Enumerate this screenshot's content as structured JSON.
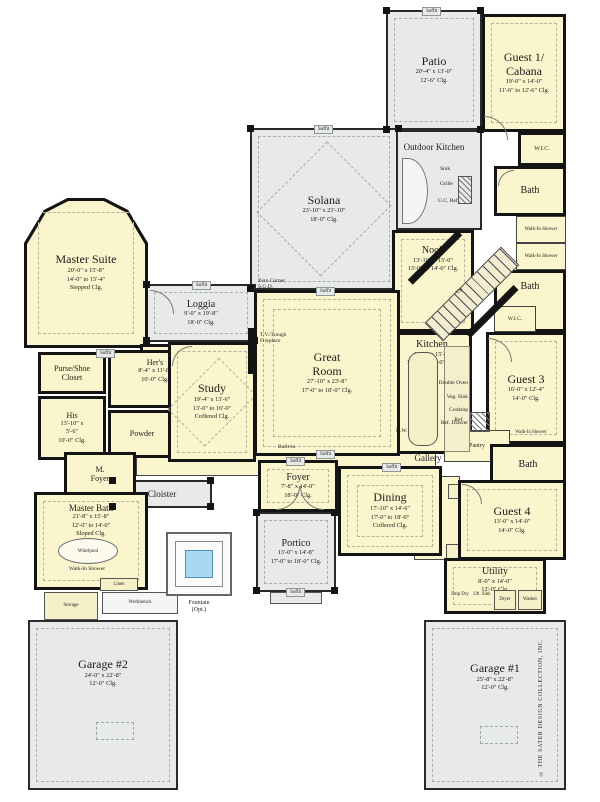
{
  "colors": {
    "room_fill": "#FAF5CC",
    "outdoor_fill": "#E8E9E9",
    "wall": "#141414",
    "fountain_water": "#A9D9F0"
  },
  "credit": "© THE SATER DESIGN COLLECTION, INC.",
  "labels": {
    "soffit": "Soffit",
    "up": "Up",
    "zero_corner": "Zero Corner",
    "sgd": "S.G.D.",
    "fireplace1": "T.V./Trough",
    "fireplace2": "Fireplace",
    "built_in": "Built-in",
    "gallery": "Gallery",
    "ref": "Ref.",
    "pantry": "Pantry",
    "linen": "Linen",
    "vest": "Vest",
    "closet": "Closet",
    "powder": "Powder",
    "storage": "Storage",
    "workbench": "Workbench",
    "whirlpool": "Whirlpool",
    "walk_in_shower": "Walk-In Shower",
    "wic": "W.I.C.",
    "bath": "Bath",
    "sink": "Sink",
    "grille": "Grille",
    "uc_ref": "U.C. Ref.",
    "dw": "D.W.",
    "double_oven": "Double Oven",
    "veg_sink": "Veg. Sink",
    "cooktop": "Cooktop",
    "ref_drawer": "Ref. Drawer",
    "drip_dry": "Drip Dry",
    "utl_sink": "Utl. Sink",
    "dryer": "Dryer",
    "washer": "Washer",
    "fountain": "Fountain",
    "fountain_opt": "(Opt.)"
  },
  "rooms": {
    "patio": {
      "name": "Patio",
      "l1": "20'-4\" x 13'-0\"",
      "l2": "12'-6\" Clg."
    },
    "guest1": {
      "name": "Guest 1/",
      "name2": "Cabana",
      "l1": "19'-0\" x 14'-0\"",
      "l2": "11'-6\" to 12'-6\" Clg."
    },
    "outdoor_kitchen": {
      "name": "Outdoor Kitchen"
    },
    "solana": {
      "name": "Solana",
      "l1": "23'-10\" x 23'-10\"",
      "l2": "18'-0\" Clg."
    },
    "nook": {
      "name": "Nook",
      "l1": "13'-10\" x 15'-0\"",
      "l2": "13'-0\" to 14'-0\" Clg."
    },
    "kitchen": {
      "name": "Kitchen",
      "l1": "19'-2\" x 15'-0\"",
      "l2": "13'-0\" to 14'-0\" Clg."
    },
    "guest3": {
      "name": "Guest 3",
      "l1": "16'-0\" x 12'-4\"",
      "l2": "14'-0\" Clg."
    },
    "master_suite": {
      "name": "Master Suite",
      "l1": "20'-0\" x 15'-8\"",
      "l2": "14'-0\" to 15'-4\"",
      "l3": "Stepped Clg."
    },
    "loggia": {
      "name": "Loggia",
      "l1": "9'-0\" x 19'-8\"",
      "l2": "18'-0\" Clg."
    },
    "pool_bath": {
      "name": "Pool",
      "name2": "Bath"
    },
    "study": {
      "name": "Study",
      "l1": "19'-4\" x 13'-6\"",
      "l2": "13'-0\" to 16'-0\"",
      "l3": "Coffered Clg."
    },
    "great_room": {
      "name": "Great",
      "name2": "Room",
      "l1": "27'-10\" x 23'-8\"",
      "l2": "17'-0\" to 18'-0\" Clg."
    },
    "purse_shoe": {
      "name": "Purse/Shoe",
      "name2": "Closet"
    },
    "hers": {
      "name": "Her's",
      "l1": "8'-4\" x 11'-8\"",
      "l2": "10'-0\" Clg."
    },
    "his": {
      "name": "His",
      "l1": "13'-10\" x",
      "l2": "5'-6\"",
      "l3": "10'-0\" Clg."
    },
    "m_foyer": {
      "name": "M.",
      "name2": "Foyer"
    },
    "cloister": {
      "name": "Cloister"
    },
    "foyer": {
      "name": "Foyer",
      "l1": "7'-8\" x 14'-0\"",
      "l2": "18'-0\" Clg."
    },
    "dining": {
      "name": "Dining",
      "l1": "17'-10\" x 14'-6\"",
      "l2": "17'-0\" to 18'-0\"",
      "l3": "Coffered Clg."
    },
    "portico": {
      "name": "Portico",
      "l1": "13'-0\" x 14'-8\"",
      "l2": "17'-0\" to 18'-0\" Clg."
    },
    "master_bath": {
      "name": "Master Bath",
      "l1": "21'-8\" x 15'-8\"",
      "l2": "12'-0\" to 14'-0\"",
      "l3": "Sloped Clg."
    },
    "guest4": {
      "name": "Guest 4",
      "l1": "13'-0\" x 14'-0\"",
      "l2": "14'-0\" Clg."
    },
    "utility": {
      "name": "Utility",
      "l1": "8'-0\" x 14'-0\"",
      "l2": "12'-0\" Clg."
    },
    "garage2": {
      "name": "Garage #2",
      "l1": "24'-0\" x 22'-8\"",
      "l2": "12'-0\" Clg."
    },
    "garage1": {
      "name": "Garage #1",
      "l1": "25'-8\" x 22'-8\"",
      "l2": "12'-0\" Clg."
    }
  }
}
